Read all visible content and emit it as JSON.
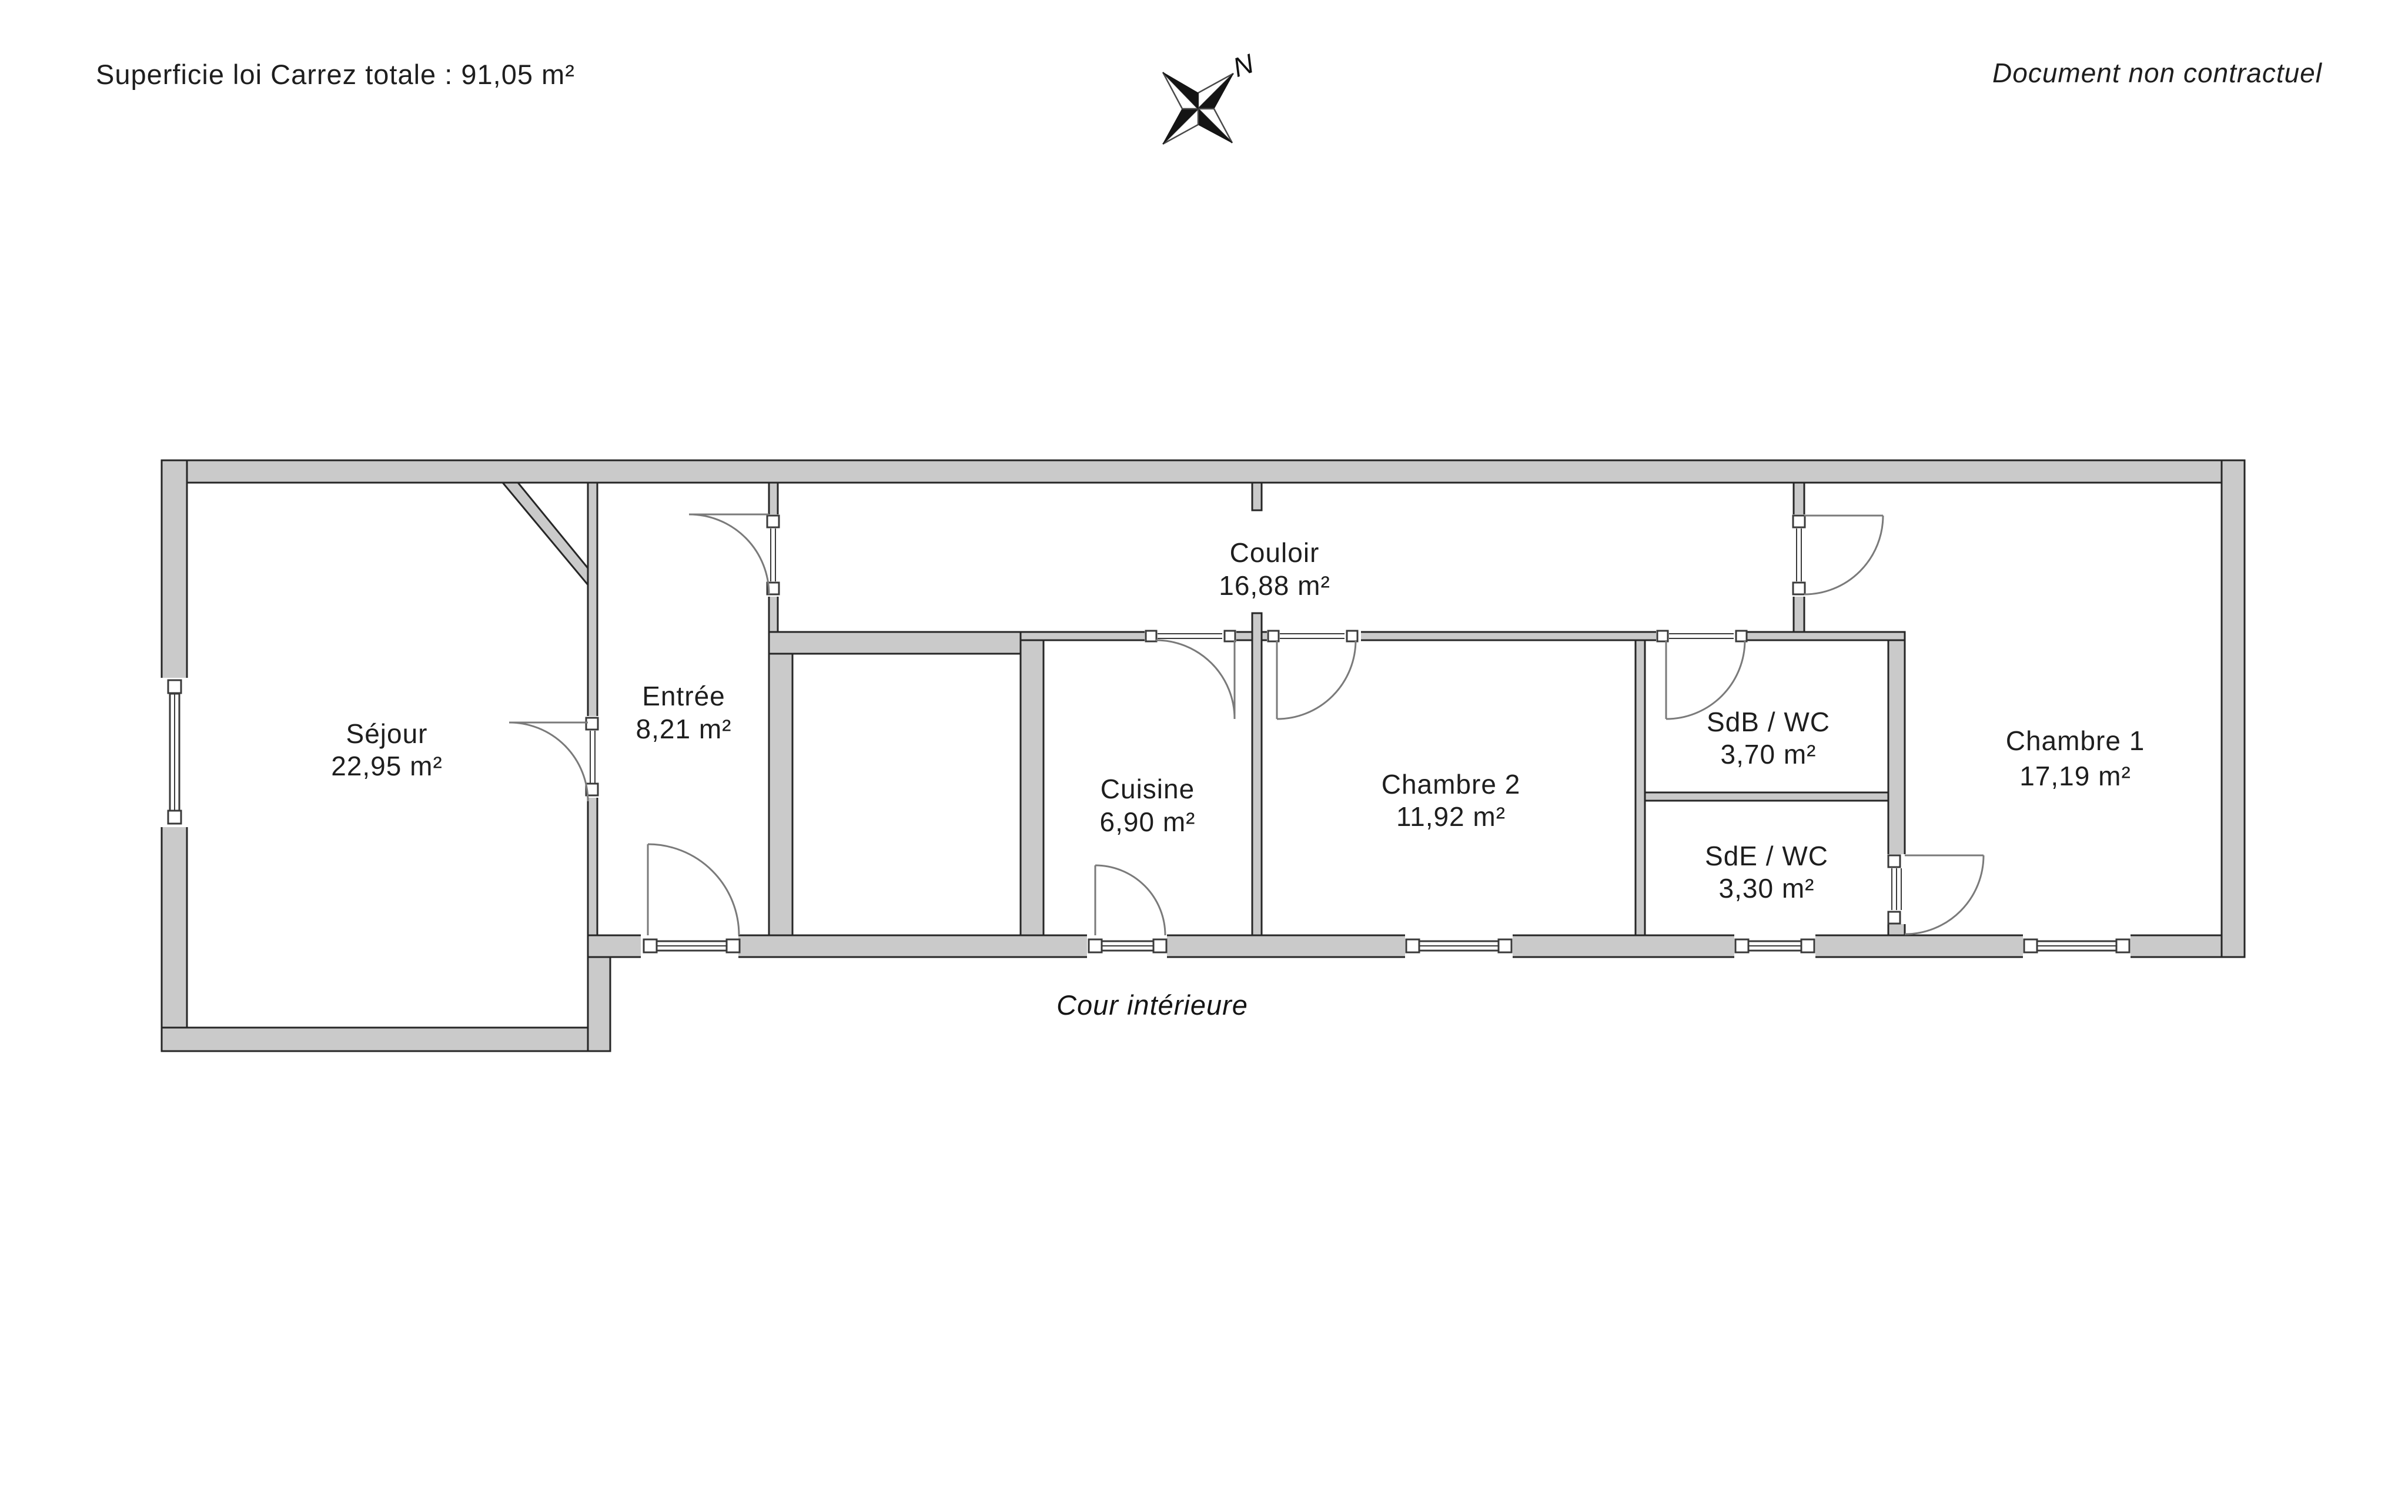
{
  "header": {
    "left": "Superficie loi Carrez totale :  91,05 m²",
    "right": "Document non contractuel"
  },
  "compass": {
    "north_label": "N"
  },
  "plan": {
    "total_area_label": "91,05 m²",
    "rooms": [
      {
        "name": "Séjour",
        "area": "22,95 m²"
      },
      {
        "name": "Entrée",
        "area": "8,21 m²"
      },
      {
        "name": "Couloir",
        "area": "16,88 m²"
      },
      {
        "name": "Cuisine",
        "area": "6,90 m²"
      },
      {
        "name": "Chambre 2",
        "area": "11,92 m²"
      },
      {
        "name": "SdB / WC",
        "area": "3,70 m²"
      },
      {
        "name": "SdE / WC",
        "area": "3,30 m²"
      },
      {
        "name": "Chambre 1",
        "area": "17,19 m²"
      }
    ],
    "outdoor_label": "Cour intérieure"
  }
}
